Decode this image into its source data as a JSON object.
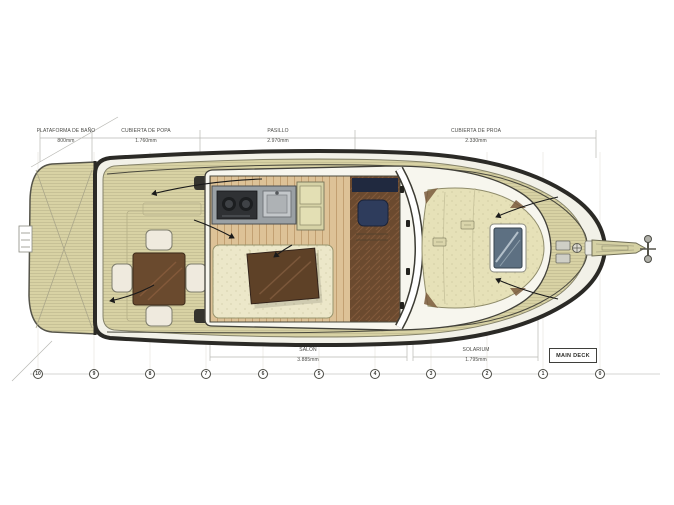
{
  "drawing_title": "MAIN DECK",
  "dimensions_top": [
    {
      "label": "PLATAFORMA DE BAÑO",
      "value": "800mm"
    },
    {
      "label": "CUBIERTA DE POPA",
      "value": "1.760mm"
    },
    {
      "label": "PASILLO",
      "value": "2.970mm"
    },
    {
      "label": "CUBIERTA DE PROA",
      "value": "2.330mm"
    }
  ],
  "dimensions_bottom": [
    {
      "label": "SALON",
      "value": "3.885mm"
    },
    {
      "label": "SOLARIUM",
      "value": "1.795mm"
    }
  ],
  "stations": [
    "10",
    "9",
    "8",
    "7",
    "6",
    "5",
    "4",
    "3",
    "2",
    "1",
    "0"
  ],
  "colors": {
    "deck": "#d8d2a4",
    "hull_outline": "#2b2a26",
    "gunwale": "#f2f1e8",
    "light_wood": "#ddc297",
    "walnut": "#6b4a2f",
    "upholstery": "#ece7c9",
    "table_wood": "#5e4127",
    "sunpad": "#e6e1b8",
    "counter": "#9aa0a4",
    "hatch": "#5d7082",
    "helm": "#2e3c5c"
  }
}
